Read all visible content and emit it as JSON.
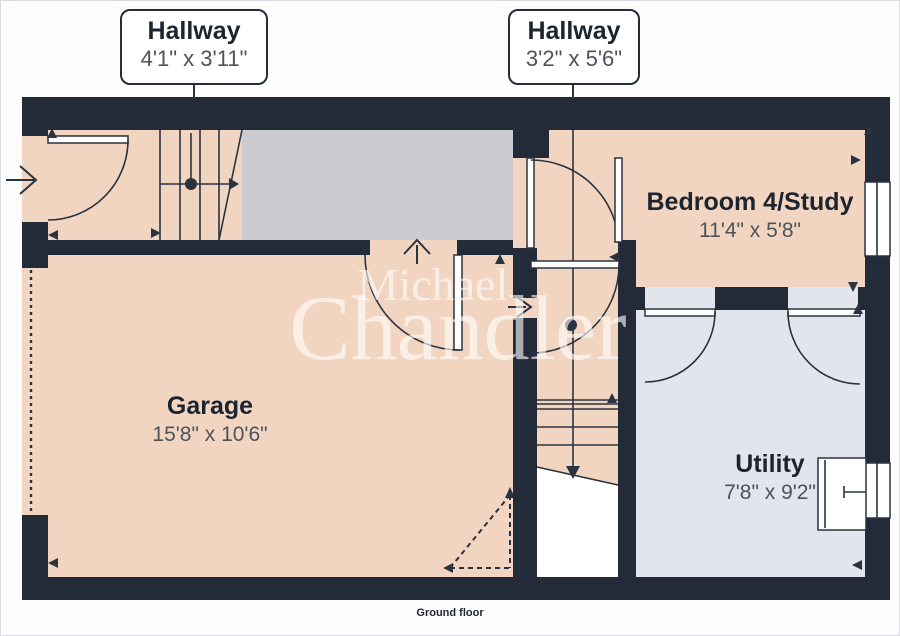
{
  "floor_label": "Ground floor",
  "watermark": {
    "line1": "Michael",
    "line2": "Chandler"
  },
  "callouts": [
    {
      "title": "Hallway",
      "dims": "4'1\" x 3'11\""
    },
    {
      "title": "Hallway",
      "dims": "3'2\" x 5'6\""
    }
  ],
  "rooms": [
    {
      "name": "Garage",
      "dims": "15'8\" x 10'6\""
    },
    {
      "name": "Bedroom 4/Study",
      "dims": "11'4\" x 5'8\""
    },
    {
      "name": "Utility",
      "dims": "7'8\" x 9'2\""
    }
  ],
  "colors": {
    "wall": "#232b39",
    "floor": "#f2d5c1",
    "stairs": "#cbccd0",
    "utility_floor": "#e2e5ee",
    "line": "#2a3340",
    "label": "#1c2430",
    "dims_text": "#4d525b",
    "watermark": "rgba(255,255,255,0.62)"
  }
}
